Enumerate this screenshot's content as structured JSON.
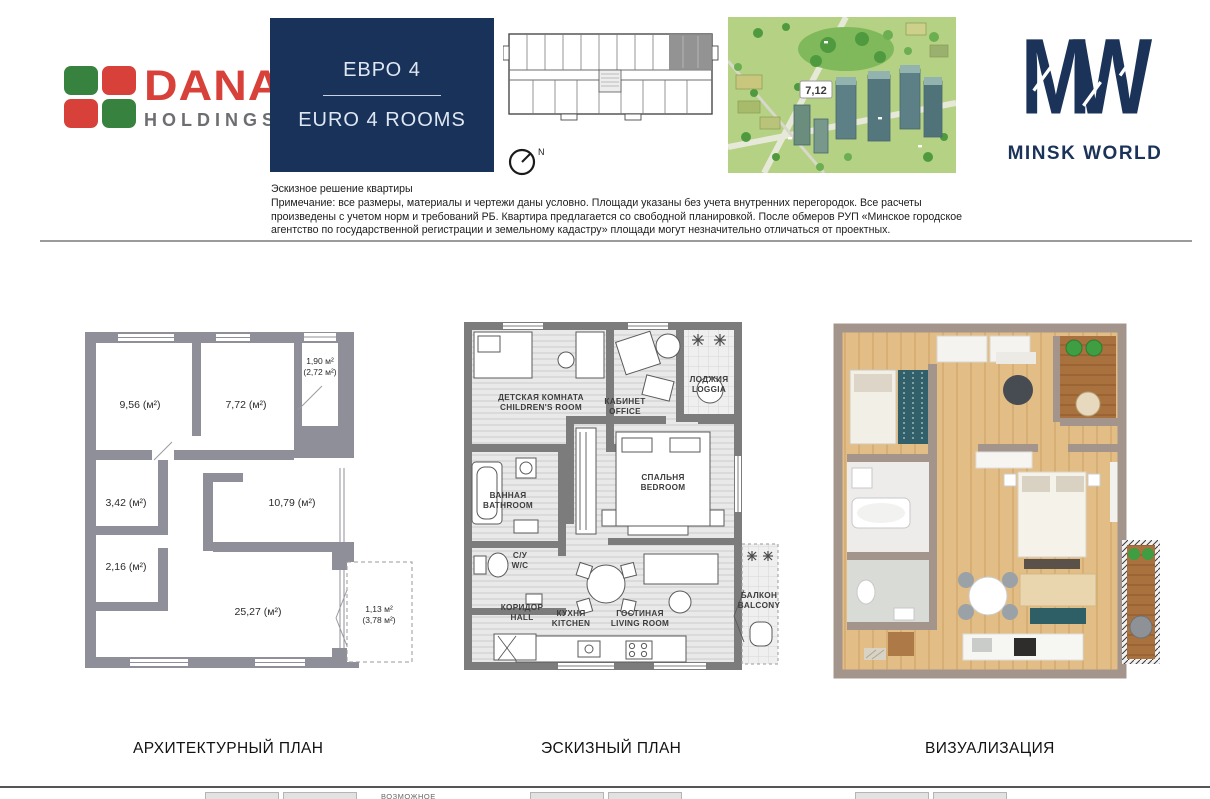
{
  "brand": {
    "dana": {
      "name": "DANA",
      "sub": "HOLDINGS"
    },
    "minsk_world": {
      "name": "MINSK WORLD"
    }
  },
  "unit": {
    "type_ru": "ЕВРО 4",
    "type_en": "EURO 4 ROOMS",
    "building_number": "7,12",
    "compass_label": "N"
  },
  "colors": {
    "navy": "#18325a",
    "dana_red": "#d8403a",
    "dana_green": "#37823f",
    "plan_wall_gray": "#8f8f99"
  },
  "disclaimer": {
    "title": "Эскизное решение квартиры",
    "body": "Примечание: все размеры, материалы и чертежи даны условно. Площади указаны без учета внутренних перегородок. Все расчеты произведены с учетом норм и требований РБ. Квартира предлагается со свободной планировкой. После обмеров РУП «Минское городское агентство по государственной регистрации и земельному кадастру» площади могут незначительно отличаться от проектных."
  },
  "architectural_plan": {
    "caption": "АРХИТЕКТУРНЫЙ ПЛАН",
    "areas": {
      "room1": "9,56 (м²)",
      "room2": "7,72 (м²)",
      "loggia_line1": "1,90 м²",
      "loggia_line2": "(2,72 м²)",
      "room3": "3,42 (м²)",
      "room4": "2,16 (м²)",
      "room5": "10,79 (м²)",
      "room6": "25,27 (м²)",
      "balcony_line1": "1,13 м²",
      "balcony_line2": "(3,78 м²)"
    }
  },
  "sketch_plan": {
    "caption": "ЭСКИЗНЫЙ ПЛАН",
    "rooms": {
      "children": {
        "ru": "ДЕТСКАЯ КОМНАТА",
        "en": "CHILDREN'S ROOM"
      },
      "office": {
        "ru": "КАБИНЕТ",
        "en": "OFFICE"
      },
      "loggia": {
        "ru": "ЛОДЖИЯ",
        "en": "LOGGIA"
      },
      "bathroom": {
        "ru": "ВАННАЯ",
        "en": "BATHROOM"
      },
      "wc": {
        "ru": "С/У",
        "en": "W/C"
      },
      "bedroom": {
        "ru": "СПАЛЬНЯ",
        "en": "BEDROOM"
      },
      "hall": {
        "ru": "КОРИДОР",
        "en": "HALL"
      },
      "kitchen": {
        "ru": "КУХНЯ",
        "en": "KITCHEN"
      },
      "living": {
        "ru": "ГОСТИНАЯ",
        "en": "LIVING ROOM"
      },
      "balcony": {
        "ru": "БАЛКОН",
        "en": "BALCONY"
      }
    }
  },
  "visualization": {
    "caption": "ВИЗУАЛИЗАЦИЯ"
  },
  "footer": {
    "partial_label": "ВОЗМОЖНОЕ"
  }
}
